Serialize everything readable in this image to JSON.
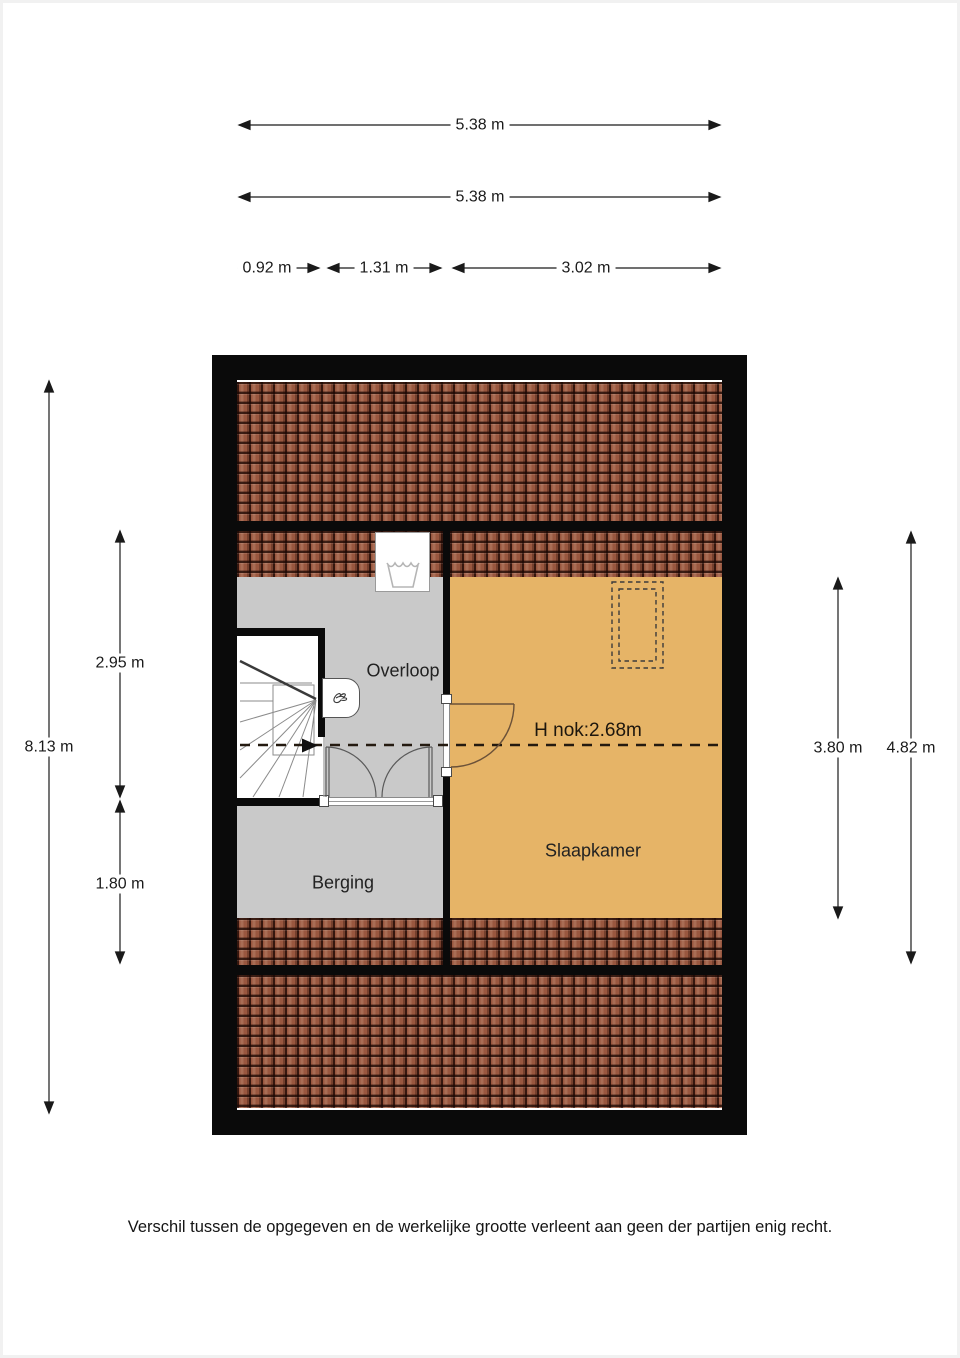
{
  "plan": {
    "rooms": [
      {
        "id": "overloop",
        "label": "Overloop"
      },
      {
        "id": "berging",
        "label": "Berging"
      },
      {
        "id": "slaapkamer",
        "label": "Slaapkamer"
      }
    ],
    "ridge_label": "H nok:2.68m"
  },
  "dimensions": {
    "top_row1": "5.38 m",
    "top_row2": "5.38 m",
    "top_segments": [
      "0.92 m",
      "1.31 m",
      "3.02 m"
    ],
    "left_total": "8.13 m",
    "left_upper": "2.95 m",
    "left_lower": "1.80 m",
    "right_inner": "3.80 m",
    "right_outer": "4.82 m"
  },
  "icons": {
    "laundry_tub": "laundry-tub-icon",
    "ventilation": "ventilation-unit-icon",
    "walkline_arrow": "stair-direction-arrow-icon"
  },
  "colors": {
    "wall": "#0a0a0a",
    "roof_tile": "#99573f",
    "floor_gray": "#c9c9c9",
    "floor_orange": "#e6b467",
    "dim_text": "#1a1a1a"
  },
  "footer": "Verschil tussen de opgegeven en de werkelijke grootte verleent aan geen der partijen enig recht."
}
